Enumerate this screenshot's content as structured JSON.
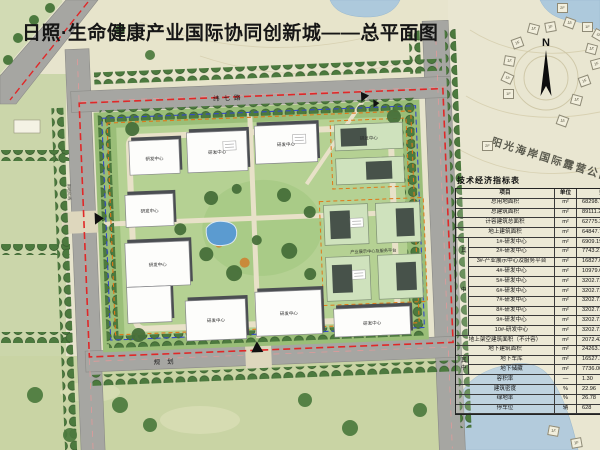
{
  "title": "日照·生命健康产业国际协同创新城——总平面图",
  "map": {
    "park_label": "阳光海岸国际露营公园",
    "compass": "N",
    "roads": {
      "top": "纬七路",
      "bottom": "规划",
      "boundary_note": "用地红线"
    },
    "buildings": {
      "b0": "研发中心",
      "b1": "研发中心",
      "b2": "研发中心",
      "b3": "研发中心",
      "b4": "研发中心",
      "b6": "研发中心",
      "b9": "研发中心",
      "etop": "研发中心",
      "e3": "研发中心",
      "ebig": "产业展示中心及服务平台"
    },
    "cabins": [
      "2F",
      "1F",
      "1F",
      "1F",
      "1F",
      "1F",
      "1F",
      "1F",
      "1F",
      "1F",
      "1F",
      "1F",
      "1F",
      "1F",
      "1F",
      "2F",
      "1F",
      "1F"
    ]
  },
  "table": {
    "title": "技术经济指标表",
    "headers": {
      "item": "项目",
      "unit": "单位",
      "value": "数值"
    },
    "among": "其中",
    "rows": [
      {
        "item": "总用地面积",
        "unit": "m²",
        "value": "68298.7"
      },
      {
        "item": "总建筑面积",
        "unit": "m²",
        "value": "89111.2"
      },
      {
        "item": "计容建筑总面积",
        "unit": "m²",
        "value": "62775.3"
      },
      {
        "item": "地上建筑面积",
        "unit": "m²",
        "value": "64847.7"
      },
      {
        "item": "1#-研发中心",
        "unit": "m²",
        "value": "6909.19"
      },
      {
        "item": "2#-研发中心",
        "unit": "m²",
        "value": "7743.21"
      },
      {
        "item": "3#-产业展示中心及服务平台",
        "unit": "m²",
        "value": "16827.02"
      },
      {
        "item": "4#-研发中心",
        "unit": "m²",
        "value": "10979.6"
      },
      {
        "item": "5#-研发中心",
        "unit": "m²",
        "value": "3202.71"
      },
      {
        "item": "6#-研发中心",
        "unit": "m²",
        "value": "3202.71"
      },
      {
        "item": "7#-研发中心",
        "unit": "m²",
        "value": "3202.71"
      },
      {
        "item": "8#-研发中心",
        "unit": "m²",
        "value": "3202.71"
      },
      {
        "item": "9#-研发中心",
        "unit": "m²",
        "value": "3202.71"
      },
      {
        "item": "10#-研发中心",
        "unit": "m²",
        "value": "3202.71"
      },
      {
        "item": "地上架空建筑面积（不计容）",
        "unit": "m²",
        "value": "2072.43"
      },
      {
        "item": "地下建筑面积",
        "unit": "m²",
        "value": "24263.10"
      },
      {
        "item": "地下车库",
        "unit": "m²",
        "value": "16527.1"
      },
      {
        "item": "地下储藏",
        "unit": "m²",
        "value": "7736.00"
      },
      {
        "item": "容积率",
        "unit": "—",
        "value": "1.30"
      },
      {
        "item": "建筑密度",
        "unit": "%",
        "value": "22.96"
      },
      {
        "item": "绿地率",
        "unit": "%",
        "value": "26.78"
      },
      {
        "item": "停车位",
        "unit": "辆",
        "value": "628"
      }
    ]
  }
}
